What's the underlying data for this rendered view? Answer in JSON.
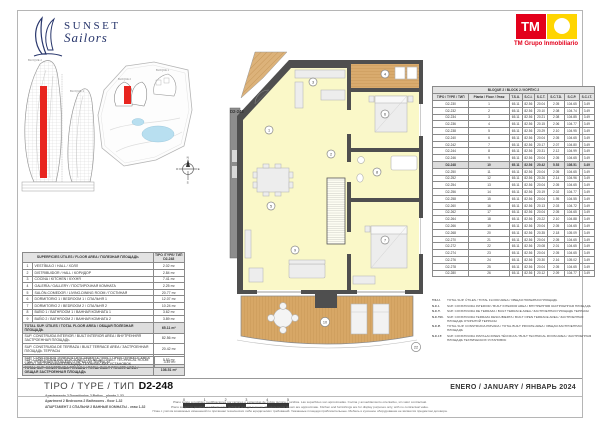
{
  "colors": {
    "tm_red": "#e3001b",
    "tm_yellow": "#ffd500",
    "highlight_red": "#e8251f",
    "room_yellow": "#faf8c8",
    "terrace_wood": "#d7a766",
    "navy": "#27356b",
    "pool_blue": "#b8dff0"
  },
  "logos": {
    "sunset_line1": "SUNSET",
    "sunset_line2": "Sailors",
    "tm_short": "TM",
    "tm_full": "TM Grupo Inmobiliario"
  },
  "site": {
    "block2_label": "BLOQUE 2",
    "block1_label": "BLOQUE 1"
  },
  "compass": {
    "n": "N",
    "s": "S",
    "e": "E",
    "w": "O"
  },
  "meta": {
    "sheet_title": "TIPO / TYPE / ТИП",
    "type_code": "D2-248",
    "date": "ENERO / JANUARY / ЯНВАРЬ 2024"
  },
  "floorplan": {
    "unit_label": "D2-248",
    "markers": [
      "1",
      "2",
      "3",
      "4",
      "5",
      "6",
      "7",
      "8",
      "9",
      "10",
      "22"
    ]
  },
  "areas_table": {
    "header_desc": "SUPERFICIES ÚTILES / FLOOR AREA / ПОЛЕЗНАЯ ПЛОЩАДЬ",
    "header_type": "TIPO /TYPE/ ТИП",
    "header_code": "D2-248",
    "rooms": [
      {
        "no": "1",
        "label": "VESTÍBULO / HALL / ХОЛЛ",
        "value": "2.02 m²"
      },
      {
        "no": "2",
        "label": "DISTRIBUIDOR / HALL / КОРИДОР",
        "value": "2.84 m²"
      },
      {
        "no": "3",
        "label": "COCINA / KITCHEN / КУХНЯ",
        "value": "7.41 m²"
      },
      {
        "no": "4",
        "label": "GALERÍA / GALLERY / ПОСТИРОЧНАЯ КОМНАТА",
        "value": "2.25 m²"
      },
      {
        "no": "5",
        "label": "SALÓN-COMEDOR / LIVING-DINING ROOM / ГОСТИНАЯ",
        "value": "20.77 m²"
      },
      {
        "no": "6",
        "label": "DORMITORIO 1 / BEDROOM 1 / СПАЛЬНЯ 1",
        "value": "12.07 m²"
      },
      {
        "no": "7",
        "label": "DORMITORIO 2 / BEDROOM 2 / СПАЛЬНЯ 2",
        "value": "10.24 m²"
      },
      {
        "no": "8",
        "label": "BAÑO 1 / BATHROOM 1 / ВАННАЯ КОМНАТА 1",
        "value": "3.62 m²"
      },
      {
        "no": "9",
        "label": "BAÑO 2 / BATHROOM 2 / ВАННАЯ КОМНАТА 2",
        "value": "3.89 m²"
      }
    ],
    "summary": [
      {
        "label": "TOTAL SUP. ÚTILES / TOTAL FLOOR AREA / ОБЩАЯ ПОЛЕЗНАЯ ПЛОЩАДЬ",
        "value": "65.11 m²",
        "total": true
      },
      {
        "label": "SUP. CONSTRUIDA INTERIOR / BUILT INTERIOR AREA / ВНУТРЕННЯЯ ЗАСТРОЕННАЯ ПЛОЩАДЬ",
        "value": "82.56 m²",
        "total": false
      },
      {
        "label": "SUP. CONSTRUIDA DE TERRAZA / BUILT TERRACE AREA / ЗАСТРОЕННАЯ ПЛОЩАДЬ ТЕРРАСЫ",
        "value": "20.42 m²",
        "total": false
      },
      {
        "label": "SUP. CONSTRUIDA TERRAZA DESCUBIERTA / BUILT OPEN TERRACE AREA / ЗАСТРОЕННАЯ ПЛОЩАДЬ ОТКРЫТОЙ ТЕРРАСЫ",
        "value": "5.53 m²",
        "total": false
      },
      {
        "label": "TOTAL SUP. CONSTRUIDA PRIVADA / TOTAL BUILT PRIVATE AREA / ОБЩАЯ ЗАСТРОЕННАЯ ПЛОЩАДЬ",
        "value": "108.51 m²",
        "total": true
      }
    ],
    "tech_row": {
      "label": "SUP. CONSTRUIDA INSTALACIONES TÉCNICAS / BUILT TECHNICAL ROOM AREA / ЗАСТРОЕННАЯ ПЛОЩАДЬ ТЕХНИЧЕСКИХ УСТАНОВОК",
      "value": "3.49 m²"
    }
  },
  "units_table": {
    "title": "BLOQUE 2 / BLOCK 2 / КОРПУС 2",
    "col_headers": [
      "TIPO / TYPE / ТИП",
      "Planta / Floor / Этаж",
      "T.S.U.",
      "S.C.I.",
      "S.C.T.",
      "S.C.T.D.",
      "S.C.P.",
      "S.C.I.T."
    ],
    "rows": [
      [
        "D2-230",
        "1",
        "65.11",
        "82.56",
        "20.04",
        "2.05",
        "104.65",
        "3.49"
      ],
      [
        "D2-232",
        "2",
        "65.11",
        "82.56",
        "20.10",
        "2.08",
        "104.74",
        "3.49"
      ],
      [
        "D2-234",
        "3",
        "65.11",
        "82.56",
        "20.21",
        "2.08",
        "104.85",
        "3.49"
      ],
      [
        "D2-236",
        "4",
        "65.11",
        "82.56",
        "20.15",
        "2.06",
        "104.77",
        "3.49"
      ],
      [
        "D2-238",
        "5",
        "65.11",
        "82.56",
        "20.29",
        "2.10",
        "104.95",
        "3.49"
      ],
      [
        "D2-240",
        "6",
        "65.11",
        "82.56",
        "20.04",
        "2.05",
        "104.65",
        "3.49"
      ],
      [
        "D2-242",
        "7",
        "65.11",
        "82.56",
        "20.17",
        "2.07",
        "104.80",
        "3.49"
      ],
      [
        "D2-244",
        "8",
        "65.11",
        "82.56",
        "20.31",
        "2.12",
        "104.99",
        "3.49"
      ],
      [
        "D2-246",
        "9",
        "65.11",
        "82.56",
        "20.04",
        "2.05",
        "104.65",
        "3.49"
      ],
      [
        "D2-248",
        "10",
        "65.11",
        "82.56",
        "20.42",
        "5.53",
        "108.51",
        "3.49"
      ],
      [
        "D2-250",
        "11",
        "65.11",
        "82.56",
        "20.04",
        "2.05",
        "104.65",
        "3.49"
      ],
      [
        "D2-252",
        "12",
        "65.11",
        "82.56",
        "20.26",
        "2.14",
        "104.96",
        "3.49"
      ],
      [
        "D2-254",
        "13",
        "65.11",
        "82.56",
        "20.04",
        "2.05",
        "104.65",
        "3.49"
      ],
      [
        "D2-256",
        "14",
        "65.11",
        "82.56",
        "20.19",
        "2.02",
        "104.77",
        "3.49"
      ],
      [
        "D2-258",
        "15",
        "65.11",
        "82.56",
        "20.04",
        "1.95",
        "104.55",
        "3.49"
      ],
      [
        "D2-260",
        "16",
        "65.11",
        "82.56",
        "20.13",
        "2.03",
        "104.72",
        "3.49"
      ],
      [
        "D2-262",
        "17",
        "65.11",
        "82.56",
        "20.04",
        "2.05",
        "104.65",
        "3.49"
      ],
      [
        "D2-264",
        "18",
        "65.11",
        "82.56",
        "20.22",
        "2.10",
        "104.88",
        "3.49"
      ],
      [
        "D2-266",
        "19",
        "65.11",
        "82.56",
        "20.04",
        "2.05",
        "104.65",
        "3.49"
      ],
      [
        "D2-268",
        "20",
        "65.11",
        "82.56",
        "20.35",
        "2.18",
        "105.09",
        "3.49"
      ],
      [
        "D2-270",
        "21",
        "65.11",
        "82.56",
        "20.04",
        "2.05",
        "104.65",
        "3.49"
      ],
      [
        "D2-272",
        "22",
        "65.11",
        "82.56",
        "20.08",
        "2.01",
        "104.65",
        "3.49"
      ],
      [
        "D2-274",
        "23",
        "65.11",
        "82.56",
        "20.04",
        "2.05",
        "104.65",
        "3.49"
      ],
      [
        "D2-276",
        "24",
        "65.11",
        "82.56",
        "20.30",
        "2.16",
        "105.02",
        "3.49"
      ],
      [
        "D2-278",
        "25",
        "65.11",
        "82.56",
        "20.04",
        "2.05",
        "104.65",
        "3.49"
      ],
      [
        "D2-280",
        "26",
        "65.11",
        "82.56",
        "20.12",
        "2.09",
        "104.77",
        "3.49"
      ]
    ]
  },
  "legend": [
    {
      "abbr": "T.S.U.",
      "text": "TOTAL SUP. ÚTILES / TOTAL FLOOR AREA / ОБЩАЯ ПОЛЕЗНАЯ ПЛОЩАДЬ"
    },
    {
      "abbr": "S.C.I.",
      "text": "SUP. CONSTRUIDA INTERIOR / BUILT INTERIOR AREA / ВНУТРЕННЯЯ ЗАСТРОЕННАЯ ПЛОЩАДЬ"
    },
    {
      "abbr": "S.C.T.",
      "text": "SUP. CONSTRUIDA DE TERRAZA / BUILT TERRACE AREA / ЗАСТРОЕННАЯ ПЛОЩАДЬ ТЕРРАСЫ"
    },
    {
      "abbr": "S.C.T.D.",
      "text": "SUP. CONSTRUIDA TERRAZA DESCUBIERTA / BUILT OPEN TERRACE AREA / ЗАСТРОЕННАЯ ПЛОЩАДЬ ОТКРЫТОЙ ТЕРРАСЫ"
    },
    {
      "abbr": "S.C.P.",
      "text": "TOTAL SUP. CONSTRUIDA PRIVADA / TOTAL BUILT PRIVATE AREA / ОБЩАЯ ЗАСТРОЕННАЯ ПЛОЩАДЬ"
    },
    {
      "abbr": "S.C.I.T.",
      "text": "SUP. CONSTRUIDA INSTALACIONES TÉCNICAS / BUILT TECHNICAL ROOM AREA / ЗАСТРОЕННАЯ ПЛОЩАДЬ ТЕХНИЧЕСКИХ УСТАНОВОК"
    }
  ],
  "caption": [
    "Apartamento 2 Dormitorios 2 Baños - planta 1-32",
    "Apartment 2 Bedrooms 2 Bathrooms - floor 1-32",
    "АПАРТАМЕНТ 2 СПАЛЬНИ 2 ВАННЫЕ КОМНАТЫ - этаж 1-32"
  ],
  "scalebar": {
    "ticks": [
      "0",
      "1",
      "2",
      "3",
      "4",
      "5"
    ]
  },
  "disclaimer": [
    "Plano sujeto a posibles modificaciones por razones o exigencias de índole técnica o jurídica. Las superficies son aproximadas. Cocina y amueblamiento orientativo, sin valor contractual.",
    "Plans subject to possible modification for technical or legal reasons. Measurements shown are approximate. Kitchen and furnishings are for display purposes only, with no contractual value.",
    "План с учётом возможных изменений по причинам технических либо юридических требований. Указанные площади приблизительные. Мебель и кухонное оборудование не являются предметом договора."
  ]
}
